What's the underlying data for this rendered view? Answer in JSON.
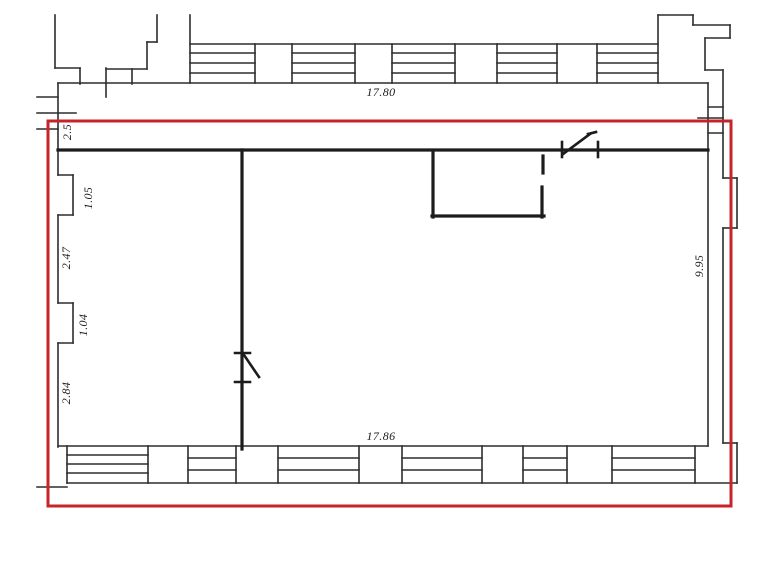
{
  "title": "Apartment floor plan with red selection outline",
  "canvas": {
    "width": 781,
    "height": 577,
    "background": "#ffffff"
  },
  "colors": {
    "ink": "#1c1c1c",
    "thin": "#2d2d2d",
    "red": "#c82328"
  },
  "dimensions": [
    {
      "name": "dim-width-top",
      "text": "17.80",
      "x": 381,
      "y": 92,
      "rotate": 0
    },
    {
      "name": "dim-width-bottom",
      "text": "17.86",
      "x": 381,
      "y": 436,
      "rotate": 0
    },
    {
      "name": "dim-height-right",
      "text": "9.95",
      "x": 699,
      "y": 266,
      "rotate": -90
    },
    {
      "name": "dim-left-top",
      "text": "2.5",
      "x": 67,
      "y": 132,
      "rotate": -90
    },
    {
      "name": "dim-left-pier1",
      "text": "1.05",
      "x": 88,
      "y": 198,
      "rotate": -90
    },
    {
      "name": "dim-left-mid",
      "text": "2.47",
      "x": 66,
      "y": 258,
      "rotate": -90
    },
    {
      "name": "dim-left-pier2",
      "text": "1.04",
      "x": 83,
      "y": 325,
      "rotate": -90
    },
    {
      "name": "dim-left-lower",
      "text": "2.84",
      "x": 66,
      "y": 393,
      "rotate": -90
    }
  ],
  "red_rect": {
    "name": "red-selection-rect",
    "x": 48,
    "y": 121,
    "width": 683,
    "height": 385,
    "stroke_width": 3
  },
  "groups": [
    {
      "name": "facade-top-left-outline",
      "color": "thin",
      "width": 1.6,
      "segments": [
        [
          55,
          15,
          55,
          68
        ],
        [
          55,
          68,
          80,
          68
        ],
        [
          80,
          68,
          80,
          84
        ],
        [
          106,
          68,
          106,
          97
        ],
        [
          106,
          69,
          147,
          69
        ],
        [
          147,
          42,
          147,
          69
        ],
        [
          147,
          42,
          157,
          42
        ],
        [
          157,
          15,
          157,
          42
        ],
        [
          132,
          69,
          132,
          84
        ],
        [
          190,
          15,
          190,
          83
        ]
      ]
    },
    {
      "name": "left-facade-ticks",
      "color": "thin",
      "width": 1.6,
      "segments": [
        [
          37,
          97,
          58,
          97
        ],
        [
          37,
          113,
          76,
          113
        ],
        [
          37,
          129,
          58,
          129
        ]
      ]
    },
    {
      "name": "facade-top-right-outline",
      "color": "thin",
      "width": 1.6,
      "segments": [
        [
          658,
          15,
          658,
          83
        ],
        [
          658,
          15,
          693,
          15
        ],
        [
          693,
          15,
          693,
          25
        ],
        [
          693,
          25,
          730,
          25
        ],
        [
          730,
          25,
          730,
          38
        ],
        [
          705,
          38,
          730,
          38
        ],
        [
          705,
          38,
          705,
          70
        ],
        [
          705,
          70,
          723,
          70
        ],
        [
          723,
          70,
          723,
          178
        ],
        [
          708,
          107,
          723,
          107
        ],
        [
          698,
          118,
          723,
          118
        ],
        [
          708,
          133,
          723,
          133
        ],
        [
          723,
          178,
          737,
          178
        ],
        [
          737,
          178,
          737,
          228
        ],
        [
          723,
          228,
          737,
          228
        ],
        [
          723,
          228,
          723,
          443
        ],
        [
          723,
          443,
          737,
          443
        ],
        [
          737,
          443,
          737,
          483
        ]
      ]
    },
    {
      "name": "top-window-band",
      "color": "thin",
      "width": 1.6,
      "segments": [
        [
          190,
          44,
          658,
          44
        ],
        [
          255,
          44,
          255,
          83
        ],
        [
          292,
          44,
          292,
          83
        ],
        [
          355,
          44,
          355,
          83
        ],
        [
          392,
          44,
          392,
          83
        ],
        [
          455,
          44,
          455,
          83
        ],
        [
          497,
          44,
          497,
          83
        ],
        [
          557,
          44,
          557,
          83
        ],
        [
          597,
          44,
          597,
          83
        ],
        [
          190,
          53,
          255,
          53
        ],
        [
          190,
          63,
          255,
          63
        ],
        [
          190,
          73,
          255,
          73
        ],
        [
          292,
          53,
          355,
          53
        ],
        [
          292,
          63,
          355,
          63
        ],
        [
          292,
          73,
          355,
          73
        ],
        [
          392,
          53,
          455,
          53
        ],
        [
          392,
          63,
          455,
          63
        ],
        [
          392,
          73,
          455,
          73
        ],
        [
          497,
          53,
          557,
          53
        ],
        [
          497,
          63,
          557,
          63
        ],
        [
          497,
          73,
          557,
          73
        ],
        [
          597,
          53,
          658,
          53
        ],
        [
          597,
          63,
          658,
          63
        ],
        [
          597,
          73,
          658,
          73
        ]
      ]
    },
    {
      "name": "exterior-walls",
      "color": "thin",
      "width": 1.6,
      "segments": [
        [
          58,
          83,
          708,
          83
        ],
        [
          58,
          83,
          58,
          175
        ],
        [
          58,
          175,
          73,
          175
        ],
        [
          73,
          175,
          73,
          215
        ],
        [
          58,
          215,
          73,
          215
        ],
        [
          58,
          215,
          58,
          303
        ],
        [
          58,
          303,
          73,
          303
        ],
        [
          73,
          303,
          73,
          343
        ],
        [
          58,
          343,
          73,
          343
        ],
        [
          58,
          343,
          58,
          447
        ],
        [
          708,
          83,
          708,
          446
        ],
        [
          58,
          446,
          708,
          446
        ]
      ]
    },
    {
      "name": "bottom-window-band",
      "color": "thin",
      "width": 1.6,
      "segments": [
        [
          67,
          483,
          737,
          483
        ],
        [
          37,
          487,
          67,
          487
        ],
        [
          67,
          446,
          67,
          483
        ],
        [
          148,
          446,
          148,
          483
        ],
        [
          188,
          446,
          188,
          483
        ],
        [
          236,
          446,
          236,
          483
        ],
        [
          278,
          446,
          278,
          483
        ],
        [
          359,
          446,
          359,
          483
        ],
        [
          402,
          446,
          402,
          483
        ],
        [
          482,
          446,
          482,
          483
        ],
        [
          523,
          446,
          523,
          483
        ],
        [
          567,
          446,
          567,
          483
        ],
        [
          612,
          446,
          612,
          483
        ],
        [
          695,
          446,
          695,
          483
        ],
        [
          67,
          455,
          148,
          455
        ],
        [
          67,
          464,
          148,
          464
        ],
        [
          67,
          473,
          148,
          473
        ],
        [
          188,
          458,
          236,
          458
        ],
        [
          188,
          470,
          236,
          470
        ],
        [
          278,
          458,
          359,
          458
        ],
        [
          278,
          470,
          359,
          470
        ],
        [
          402,
          458,
          482,
          458
        ],
        [
          402,
          470,
          482,
          470
        ],
        [
          523,
          458,
          567,
          458
        ],
        [
          523,
          470,
          567,
          470
        ],
        [
          612,
          458,
          695,
          458
        ],
        [
          612,
          470,
          695,
          470
        ]
      ]
    },
    {
      "name": "interior-walls",
      "color": "ink",
      "width": 3.2,
      "segments": [
        [
          58,
          150,
          708,
          150
        ],
        [
          242,
          150,
          242,
          449
        ],
        [
          433,
          151,
          433,
          217
        ],
        [
          432,
          216,
          544,
          216
        ],
        [
          542,
          187,
          542,
          217
        ],
        [
          543,
          156,
          543,
          173
        ]
      ]
    },
    {
      "name": "door-swing-partition",
      "color": "ink",
      "width": 2.6,
      "segments": [
        [
          235,
          353,
          250,
          353
        ],
        [
          235,
          382,
          250,
          382
        ],
        [
          244,
          355,
          259,
          377
        ]
      ]
    },
    {
      "name": "door-swing-top-wall",
      "color": "ink",
      "width": 2.6,
      "segments": [
        [
          562,
          142,
          562,
          157
        ],
        [
          598,
          142,
          598,
          157
        ],
        [
          563,
          154,
          590,
          134
        ],
        [
          588,
          134,
          596,
          132
        ]
      ]
    }
  ]
}
